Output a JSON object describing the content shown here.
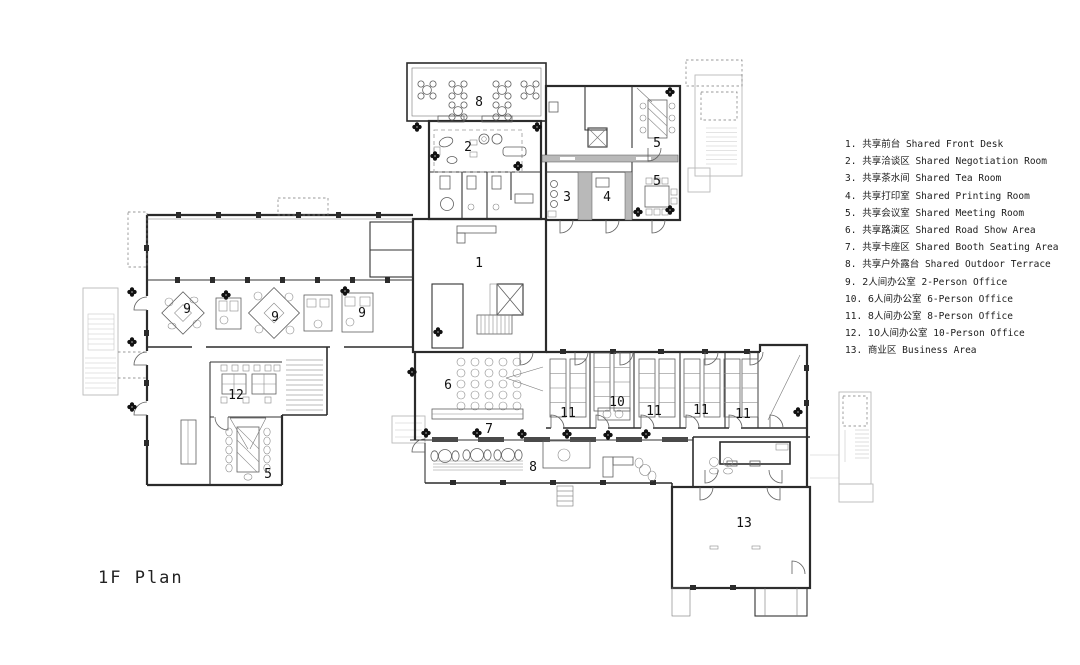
{
  "title": "1F Plan",
  "colors": {
    "wall": "#2b2b2b",
    "light_gray": "#b9b9b9",
    "text": "#1c1c1c"
  },
  "legend": {
    "items": [
      {
        "label": "1.",
        "zh": "共享前台",
        "en": "Shared Front Desk"
      },
      {
        "label": "2.",
        "zh": "共享洽谈区",
        "en": "Shared Negotiation Room"
      },
      {
        "label": "3.",
        "zh": "共享茶水间",
        "en": "Shared Tea Room"
      },
      {
        "label": "4.",
        "zh": "共享打印室",
        "en": "Shared Printing Room"
      },
      {
        "label": "5.",
        "zh": "共享会议室",
        "en": "Shared Meeting Room"
      },
      {
        "label": "6.",
        "zh": "共享路演区",
        "en": "Shared Road Show Area"
      },
      {
        "label": "7.",
        "zh": "共享卡座区",
        "en": "Shared Booth Seating Area"
      },
      {
        "label": "8.",
        "zh": "共享户外露台",
        "en": "Shared Outdoor Terrace"
      },
      {
        "label": "9.",
        "zh": "2人间办公室",
        "en": "2-Person Office"
      },
      {
        "label": "10.",
        "zh": "6人间办公室",
        "en": "6-Person Office"
      },
      {
        "label": "11.",
        "zh": "8人间办公室",
        "en": "8-Person Office"
      },
      {
        "label": "12.",
        "zh": "10人间办公室",
        "en": "10-Person Office"
      },
      {
        "label": "13.",
        "zh": "商业区",
        "en": "Business Area"
      }
    ]
  },
  "plan": {
    "room_labels": [
      {
        "name": "shared-outdoor-terrace-top",
        "number": "8"
      },
      {
        "name": "shared-negotiation-room",
        "number": "2"
      },
      {
        "name": "shared-meeting-room-a",
        "number": "5"
      },
      {
        "name": "shared-tea-room",
        "number": "3"
      },
      {
        "name": "shared-printing-room",
        "number": "4"
      },
      {
        "name": "shared-meeting-room-b",
        "number": "5"
      },
      {
        "name": "shared-front-desk",
        "number": "1"
      },
      {
        "name": "two-person-office-a",
        "number": "9"
      },
      {
        "name": "two-person-office-b",
        "number": "9"
      },
      {
        "name": "two-person-office-c",
        "number": "9"
      },
      {
        "name": "ten-person-office",
        "number": "12"
      },
      {
        "name": "shared-meeting-room-c",
        "number": "5"
      },
      {
        "name": "shared-road-show-area",
        "number": "6"
      },
      {
        "name": "shared-booth-seating-area",
        "number": "7"
      },
      {
        "name": "shared-outdoor-terrace-bottom",
        "number": "8"
      },
      {
        "name": "eight-person-office-a",
        "number": "11"
      },
      {
        "name": "six-person-office",
        "number": "10"
      },
      {
        "name": "eight-person-office-b",
        "number": "11"
      },
      {
        "name": "eight-person-office-c",
        "number": "11"
      },
      {
        "name": "eight-person-office-d",
        "number": "11"
      },
      {
        "name": "business-area",
        "number": "13"
      }
    ]
  }
}
